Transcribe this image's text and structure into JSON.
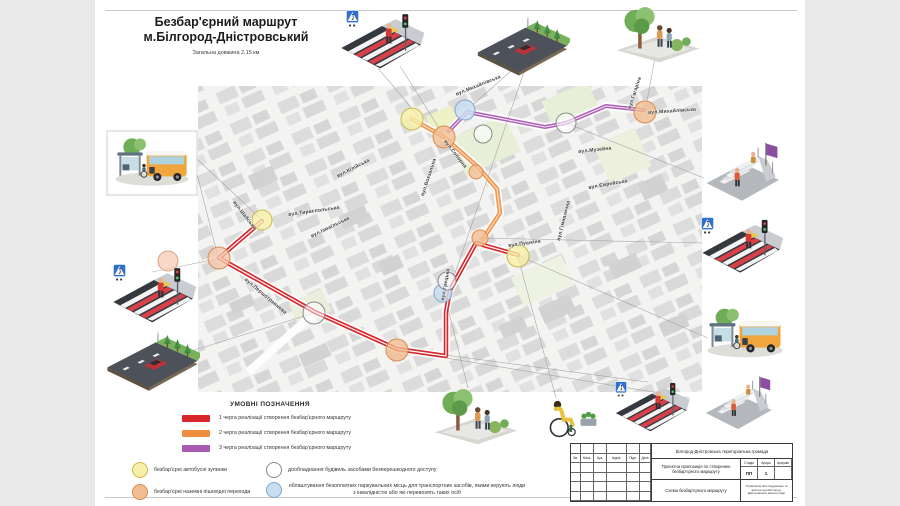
{
  "header": {
    "title_line1": "Безбар'єрний маршрут",
    "title_line2": "м.Білгород-Дністровський",
    "subtitle": "Загальна довжина 2,15 км"
  },
  "legend": {
    "title": "УМОВНІ ПОЗНАЧЕННЯ",
    "phases": [
      {
        "label": "1 черга реалізації створення безбар'єрного маршруту",
        "color": "#d7262c"
      },
      {
        "label": "2 черга реалізації створення безбар'єрного маршруту",
        "color": "#ef8d3f"
      },
      {
        "label": "3 черга реалізації створення безбар'єрного маршруту",
        "color": "#a85ab0"
      }
    ],
    "points": [
      {
        "label": "безбар'єрні автобусні зупинки",
        "color": "#f6f0a8"
      },
      {
        "label": "безбар'єрні наземні пішохідні переходи",
        "color": "#f2bd90"
      },
      {
        "label": "дообладнання будівель засобами безперешкодного доступу",
        "color": "#ffffff"
      },
      {
        "label": "облаштування безоплатних паркувальних місць для транспортних засобів, якими керують люди з інвалідністю або які перевозять таких осіб",
        "color": "#c9ddf0"
      }
    ]
  },
  "map": {
    "streets": [
      "вул.Михайлівська",
      "вул.Михайлівська",
      "вул.Гагаріна",
      "вул.Музейна",
      "вул.Єврейська",
      "вул.Соборна",
      "вул.Вокзальна",
      "вул.Кілійська",
      "вул.Ізмаїльська",
      "вул.Шабська",
      "вул.Тираспольська",
      "вул.Першотравнева",
      "вул.Грецька",
      "вул.Пушкіна",
      "вул.Гімназична"
    ]
  },
  "titleblock": {
    "community": "Білгород-Дністровська територіальна громада",
    "project": "Проектна пропозиція по створенню безбар'єрного маршруту",
    "scheme": "Схема безбар'єрного маршруту",
    "stage_label": "Стадія",
    "sheet_label": "Аркуш",
    "sheets_label": "Аркушів",
    "stage_value": "ПП",
    "sheet_value": "1",
    "sheets_value": "",
    "org": "Управління містобудування та архітектури Білгород-Дністровської міської ради",
    "row_headers": [
      "Зм.",
      "Кільк.",
      "Арк.",
      "№док.",
      "Підп.",
      "Дата"
    ]
  },
  "illustrations": [
    "accessible-crosswalk-with-traffic-light",
    "street-with-accessible-parking",
    "park-path-with-people",
    "stairs-with-ramp",
    "accessible-bus-stop",
    "person-in-wheelchair"
  ]
}
